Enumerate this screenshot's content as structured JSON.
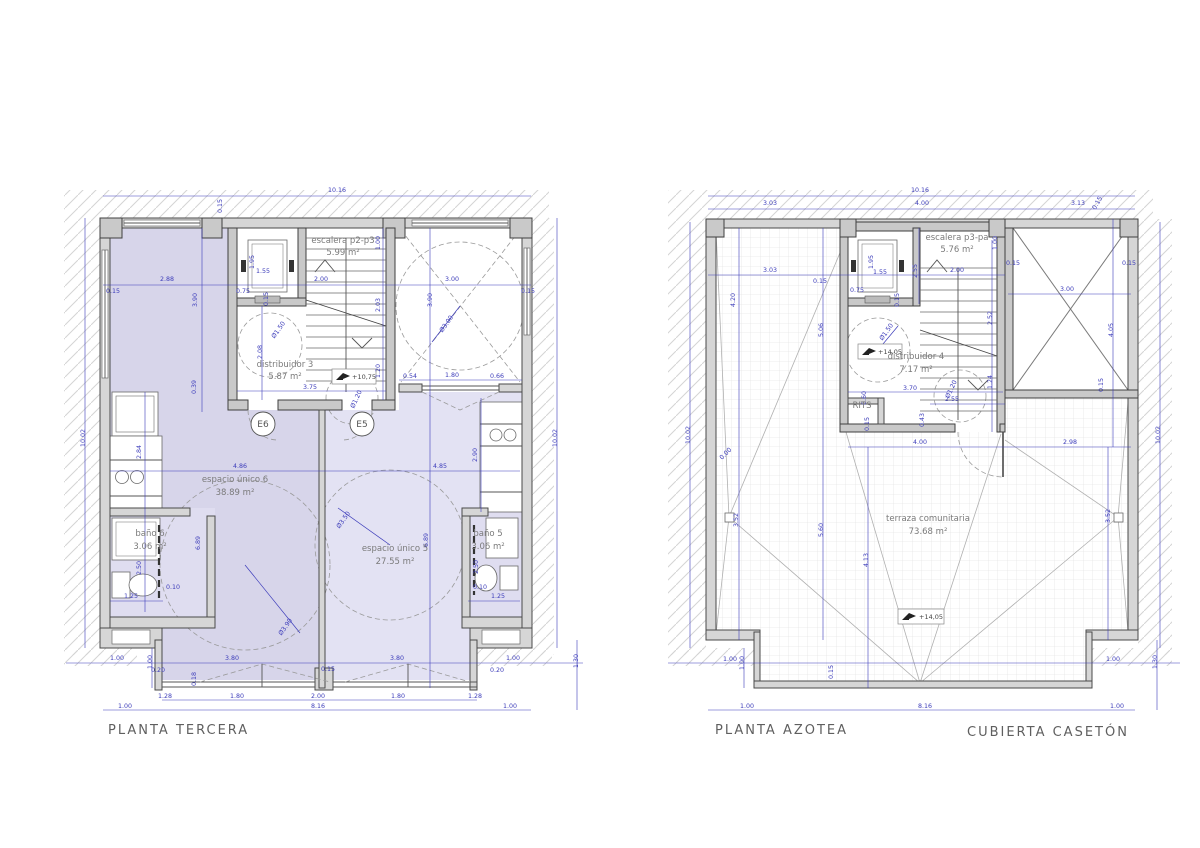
{
  "colors": {
    "dimension_blue": "#3c3cba",
    "wall_gray": "#4a4a4a",
    "room_purple": "#d7d5ea",
    "room_light_purple": "#e3e2f3",
    "bath_purple": "#dfddf0",
    "hatch_gray": "#d4d4d4"
  },
  "left_plan": {
    "title": "PLANTA TERCERA",
    "entry_labels": [
      "E6",
      "E5"
    ],
    "level_marker": "+10,75",
    "room_labels": [
      [
        343,
        243,
        "escalera p2-p3"
      ],
      [
        343,
        255,
        "5.99 m²"
      ],
      [
        285,
        367,
        "distribuidor 3"
      ],
      [
        285,
        379,
        "5.87 m²"
      ],
      [
        235,
        482,
        "espacio único 6"
      ],
      [
        235,
        495,
        "38.89 m²"
      ],
      [
        395,
        551,
        "espacio único 5"
      ],
      [
        395,
        564,
        "27.55 m²"
      ],
      [
        150,
        536,
        "baño 6"
      ],
      [
        150,
        549,
        "3.06 m²"
      ],
      [
        488,
        536,
        "baño 5"
      ],
      [
        488,
        549,
        "3.06 m²"
      ]
    ],
    "dims": [
      [
        337,
        192,
        "10.16"
      ],
      [
        222,
        206,
        "0.15",
        -90
      ],
      [
        85,
        438,
        "10.02",
        -90
      ],
      [
        557,
        438,
        "10.02",
        -90
      ],
      [
        113,
        293,
        "0.15"
      ],
      [
        167,
        281,
        "2.88"
      ],
      [
        243,
        293,
        "0.75"
      ],
      [
        263,
        273,
        "1.55"
      ],
      [
        254,
        262,
        "1.95",
        -90
      ],
      [
        268,
        299,
        "0.15",
        -90
      ],
      [
        321,
        281,
        "2.00"
      ],
      [
        452,
        281,
        "3.00"
      ],
      [
        528,
        293,
        "0.15"
      ],
      [
        262,
        352,
        "2.08",
        -90
      ],
      [
        280,
        331,
        "Ø1.50",
        -55
      ],
      [
        358,
        400,
        "Ø1.20",
        -65
      ],
      [
        310,
        389,
        "3.75"
      ],
      [
        380,
        243,
        "1.00",
        -90
      ],
      [
        380,
        305,
        "2.03",
        -90
      ],
      [
        380,
        371,
        "1.20",
        -90
      ],
      [
        432,
        300,
        "3.90",
        -90
      ],
      [
        448,
        325,
        "Ø3.00",
        -55
      ],
      [
        410,
        378,
        "0.54"
      ],
      [
        452,
        377,
        "1.80"
      ],
      [
        497,
        378,
        "0.66"
      ],
      [
        240,
        468,
        "4.86"
      ],
      [
        440,
        468,
        "4.85"
      ],
      [
        197,
        300,
        "3.90",
        -90
      ],
      [
        196,
        387,
        "0.39",
        -90
      ],
      [
        200,
        543,
        "6.89",
        -90
      ],
      [
        428,
        540,
        "6.89",
        -90
      ],
      [
        141,
        452,
        "2.84",
        -90
      ],
      [
        141,
        568,
        "2.50",
        -90
      ],
      [
        131,
        598,
        "1.25"
      ],
      [
        173,
        589,
        "0.10"
      ],
      [
        477,
        455,
        "2.90",
        -90
      ],
      [
        478,
        567,
        "2.50",
        -90
      ],
      [
        480,
        589,
        "0.10"
      ],
      [
        498,
        598,
        "1.25"
      ],
      [
        345,
        521,
        "Ø3.50",
        -55
      ],
      [
        287,
        628,
        "Ø3.90",
        -55
      ],
      [
        117,
        660,
        "1.00"
      ],
      [
        232,
        660,
        "3.80"
      ],
      [
        397,
        660,
        "3.80"
      ],
      [
        513,
        660,
        "1.00"
      ],
      [
        152,
        662,
        "1.00",
        -90
      ],
      [
        158,
        672,
        "0.20"
      ],
      [
        328,
        671,
        "0.15"
      ],
      [
        497,
        672,
        "0.20"
      ],
      [
        196,
        679,
        "0.18",
        -90
      ],
      [
        165,
        698,
        "1.28"
      ],
      [
        237,
        698,
        "1.80"
      ],
      [
        318,
        698,
        "2.00"
      ],
      [
        398,
        698,
        "1.80"
      ],
      [
        475,
        698,
        "1.28"
      ],
      [
        125,
        708,
        "1.00"
      ],
      [
        318,
        708,
        "8.16"
      ],
      [
        510,
        708,
        "1.00"
      ],
      [
        578,
        661,
        "1.30",
        -90
      ]
    ]
  },
  "right_plan": {
    "title": "PLANTA AZOTEA",
    "title_caseton": "CUBIERTA CASETÓN",
    "level_markers": [
      "+14,05",
      "+14,05"
    ],
    "room_labels": [
      [
        957,
        240,
        "escalera p3-pa"
      ],
      [
        957,
        252,
        "5.76 m²"
      ],
      [
        916,
        359,
        "distribuidor 4"
      ],
      [
        916,
        372,
        "7.17 m²"
      ],
      [
        928,
        521,
        "terraza comunitaria"
      ],
      [
        928,
        534,
        "73.68 m²"
      ],
      [
        862,
        408,
        "RITS"
      ]
    ],
    "dims": [
      [
        920,
        192,
        "10.16"
      ],
      [
        770,
        205,
        "3.03"
      ],
      [
        922,
        205,
        "4.00"
      ],
      [
        1078,
        205,
        "3.13"
      ],
      [
        1099,
        204,
        "0.15",
        -60
      ],
      [
        690,
        435,
        "10.02",
        -90
      ],
      [
        1160,
        435,
        "10.02",
        -90
      ],
      [
        770,
        272,
        "3.03"
      ],
      [
        820,
        283,
        "0.15"
      ],
      [
        873,
        262,
        "1.95",
        -90
      ],
      [
        880,
        274,
        "1.55"
      ],
      [
        857,
        292,
        "0.75"
      ],
      [
        899,
        300,
        "0.15",
        -90
      ],
      [
        917,
        271,
        "2.55",
        -90
      ],
      [
        957,
        272,
        "2.00"
      ],
      [
        997,
        243,
        "1.00",
        -90
      ],
      [
        1013,
        265,
        "0.15"
      ],
      [
        1067,
        291,
        "3.00"
      ],
      [
        1129,
        265,
        "0.15"
      ],
      [
        1113,
        330,
        "4.05",
        -90
      ],
      [
        1103,
        385,
        "0.15",
        -90
      ],
      [
        735,
        300,
        "4.20",
        -90
      ],
      [
        823,
        330,
        "5.06",
        -90
      ],
      [
        823,
        530,
        "5.60",
        -90
      ],
      [
        868,
        560,
        "4.13",
        -90
      ],
      [
        727,
        455,
        "0.00",
        -45
      ],
      [
        738,
        520,
        "3.52",
        -90
      ],
      [
        1110,
        516,
        "3.52",
        -90
      ],
      [
        910,
        390,
        "3.70"
      ],
      [
        952,
        401,
        "2.55"
      ],
      [
        866,
        398,
        "0.60",
        -90
      ],
      [
        869,
        424,
        "0.15",
        -90
      ],
      [
        924,
        420,
        "0.43",
        -90
      ],
      [
        992,
        382,
        "1.24",
        -90
      ],
      [
        992,
        318,
        "2.52",
        -90
      ],
      [
        920,
        444,
        "4.00"
      ],
      [
        1070,
        444,
        "2.98"
      ],
      [
        888,
        333,
        "Ø1.50",
        -55
      ],
      [
        953,
        390,
        "Ø1.20",
        -65
      ],
      [
        730,
        661,
        "1.00"
      ],
      [
        744,
        663,
        "1.00",
        -90
      ],
      [
        833,
        672,
        "0.15",
        -90
      ],
      [
        1113,
        661,
        "1.00"
      ],
      [
        1157,
        662,
        "1.30",
        -90
      ],
      [
        747,
        708,
        "1.00"
      ],
      [
        925,
        708,
        "8.16"
      ],
      [
        1117,
        708,
        "1.00"
      ]
    ]
  }
}
